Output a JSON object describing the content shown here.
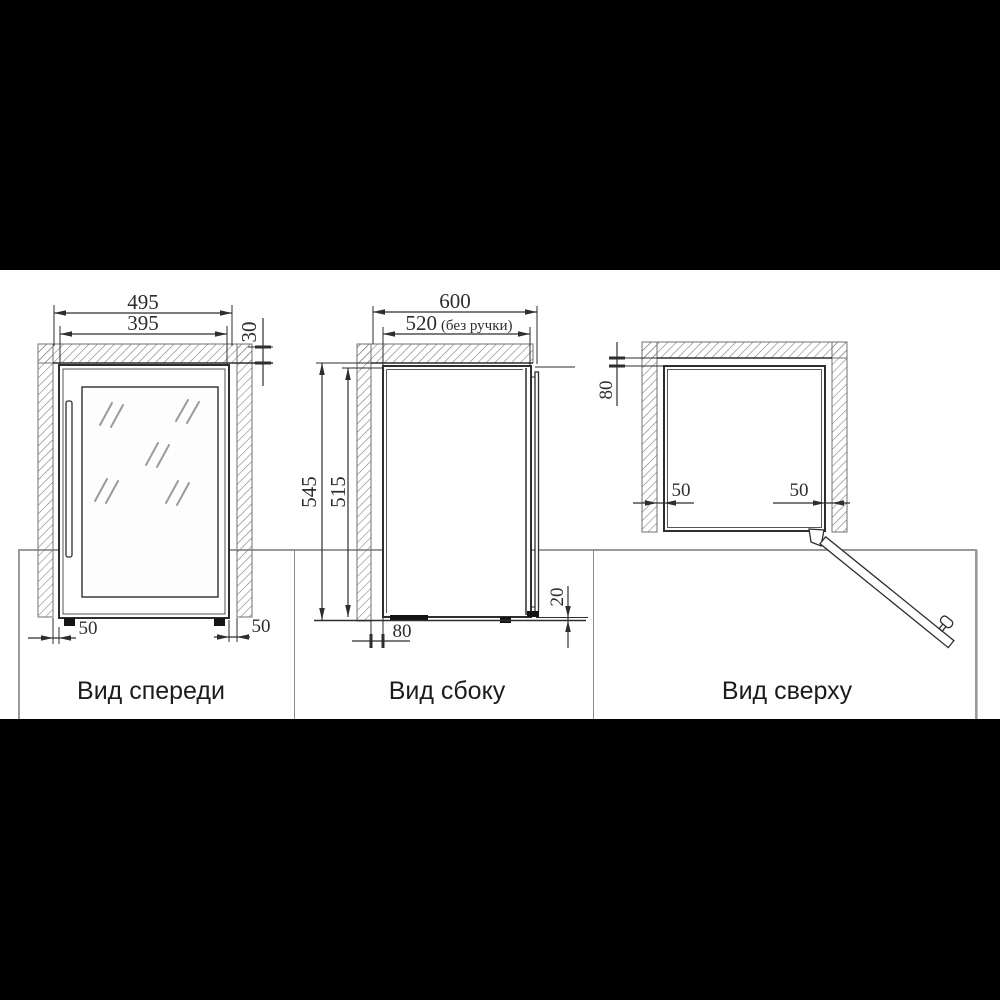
{
  "colors": {
    "page-bg": "#000000",
    "paper": "#ffffff",
    "border": "#9a9a9a",
    "divider": "#8c8c8c",
    "line": "#2e2e2e",
    "thin": "#565656",
    "hatch": "#707070",
    "glass-line": "#9b9b9b",
    "label": "#1c1c1c"
  },
  "views": {
    "front": {
      "label": "Вид спереди",
      "dim_overall_width": "495",
      "dim_unit_width": "395",
      "dim_top_clearance": "30",
      "dim_left_clearance": "50",
      "dim_right_clearance": "50"
    },
    "side": {
      "label": "Вид сбоку",
      "dim_overall_depth": "600",
      "dim_depth_value": "520",
      "dim_depth_note": "(без ручки)",
      "dim_niche_height": "545",
      "dim_unit_height": "515",
      "dim_rear_clearance": "80",
      "dim_floor_clearance": "20"
    },
    "top": {
      "label": "Вид сверху",
      "dim_rear_clearance": "80",
      "dim_left_clearance": "50",
      "dim_right_clearance": "50"
    }
  }
}
